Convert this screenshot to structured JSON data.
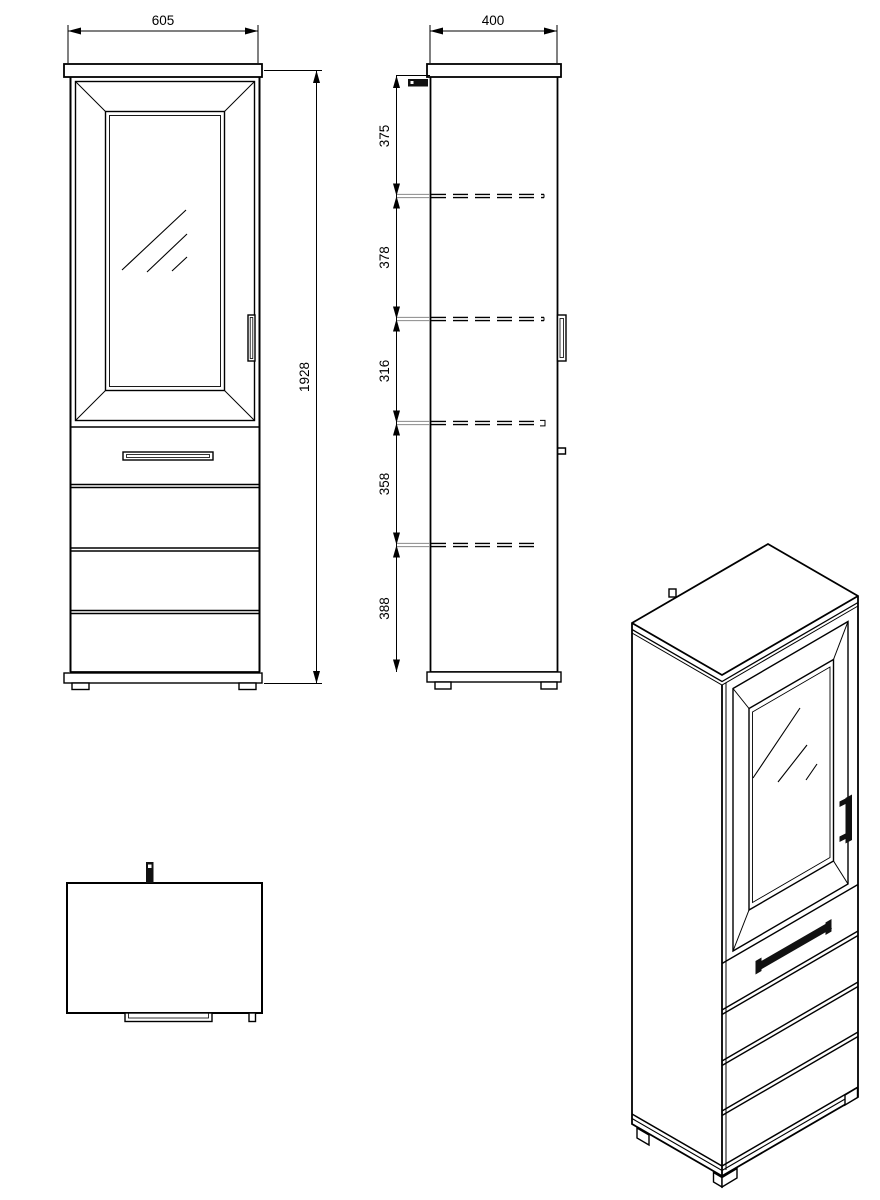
{
  "views": {
    "front": {
      "width_dim": "605",
      "height_dim": "1928"
    },
    "side": {
      "depth_dim": "400",
      "shelf_dims": [
        "375",
        "378",
        "316",
        "358",
        "388"
      ]
    }
  },
  "colors": {
    "line": "#000000",
    "background": "#ffffff",
    "handle_fill": "#111111"
  }
}
